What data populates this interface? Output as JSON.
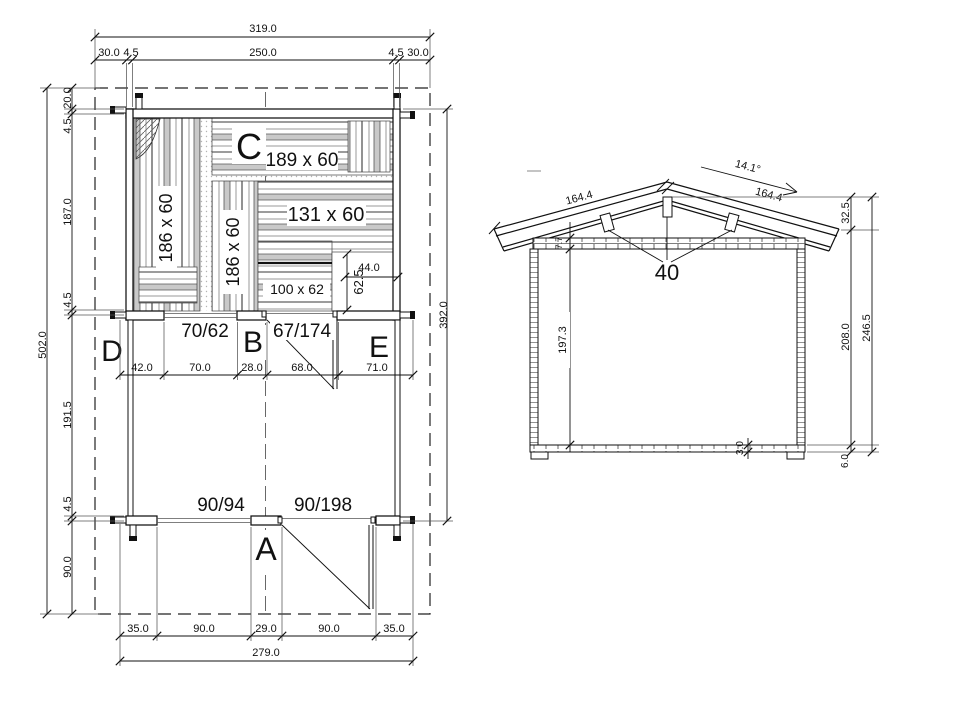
{
  "floor_plan": {
    "letters": {
      "A": "A",
      "B": "B",
      "C": "C",
      "D": "D",
      "E": "E"
    },
    "top": {
      "total": "319.0",
      "segments": [
        "30.0",
        "4.5",
        "250.0",
        "4.5",
        "30.0"
      ]
    },
    "left": {
      "total": "502.0",
      "segments": [
        "20.0",
        "4.5",
        "187.0",
        "4.5",
        "191.5",
        "4.5",
        "90.0"
      ]
    },
    "right": {
      "height": "392.0"
    },
    "middle": {
      "segments": [
        "42.0",
        "70.0",
        "28.0",
        "68.0",
        "71.0"
      ]
    },
    "bottom": {
      "segments": [
        "35.0",
        "90.0",
        "29.0",
        "90.0",
        "35.0"
      ],
      "total": "279.0"
    },
    "panels": {
      "left_vertical": "186 x 60",
      "center_vertical": "186 x 60",
      "top_horizontal": "189 x 60",
      "right_horizontal": "131 x 60",
      "bottom_horizontal": "100 x 62"
    },
    "cutout": {
      "width": "44.0",
      "height": "62.5"
    },
    "openings": {
      "window_mid": "70/62",
      "door_mid": "67/174",
      "window_bottom": "90/94",
      "door_bottom": "90/198"
    }
  },
  "elevation": {
    "roof_angle": "14.1°",
    "rafter_left": "164.4",
    "rafter_right": "164.4",
    "ridge_height": "32.5",
    "roof_thickness": "7.7",
    "bracket_label": "40",
    "inner_height": "197.3",
    "floor_thickness": "3.0",
    "wall_height": "208.0",
    "total_height": "246.5",
    "base_height": "6.0"
  },
  "colors": {
    "line": "#111111",
    "hatch": "#777777",
    "background": "#ffffff"
  }
}
